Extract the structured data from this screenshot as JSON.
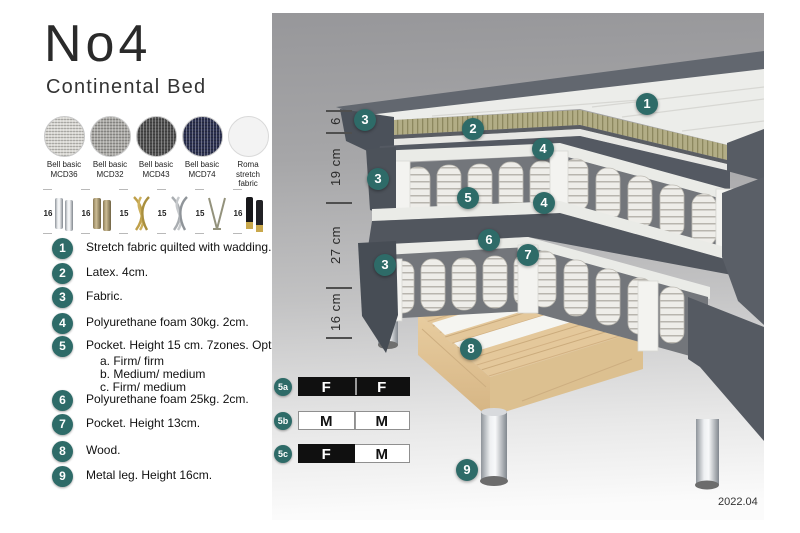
{
  "header": {
    "title": "No4",
    "subtitle": "Continental Bed"
  },
  "swatches": [
    {
      "line1": "Bell basic",
      "line2": "MCD36",
      "color": "#d8d7d2"
    },
    {
      "line1": "Bell basic",
      "line2": "MCD32",
      "color": "#a9a8a4"
    },
    {
      "line1": "Bell basic",
      "line2": "MCD43",
      "color": "#4e4e4e"
    },
    {
      "line1": "Bell basic",
      "line2": "MCD74",
      "color": "#2c3150"
    },
    {
      "line1": "Roma",
      "line2": "stretch fabric",
      "color": "#f3f3f3"
    }
  ],
  "legs": [
    {
      "height": "16",
      "type": "cylinder-silver"
    },
    {
      "height": "16",
      "type": "cylinder-brass"
    },
    {
      "height": "15",
      "type": "twisted-gold"
    },
    {
      "height": "15",
      "type": "twisted-silver"
    },
    {
      "height": "15",
      "type": "hairpin"
    },
    {
      "height": "16",
      "type": "cylinder-black-gold"
    }
  ],
  "features": [
    {
      "num": "1",
      "text": "Stretch fabric quilted with wadding."
    },
    {
      "num": "2",
      "text": "Latex. 4cm."
    },
    {
      "num": "3",
      "text": "Fabric."
    },
    {
      "num": "4",
      "text": "Polyurethane foam 30kg. 2cm."
    },
    {
      "num": "5",
      "text": "Pocket. Height 15 cm. 7zones. Option:",
      "options": [
        "a. Firm/ firm",
        "b. Medium/ medium",
        "c. Firm/ medium"
      ]
    },
    {
      "num": "6",
      "text": "Polyurethane foam 25kg. 2cm."
    },
    {
      "num": "7",
      "text": "Pocket. Height 13cm."
    },
    {
      "num": "8",
      "text": "Wood."
    },
    {
      "num": "9",
      "text": "Metal leg. Height 16cm."
    }
  ],
  "diagram": {
    "dimensions": [
      "6",
      "19 cm",
      "27 cm",
      "16 cm"
    ],
    "badges": [
      "1",
      "2",
      "3",
      "4",
      "3",
      "5",
      "4",
      "6",
      "7",
      "3",
      "8",
      "9"
    ]
  },
  "firmness": {
    "rows": [
      {
        "id": "5a",
        "cells": [
          {
            "label": "F",
            "variant": "dark"
          },
          {
            "label": "F",
            "variant": "dark"
          }
        ]
      },
      {
        "id": "5b",
        "cells": [
          {
            "label": "M",
            "variant": "light"
          },
          {
            "label": "M",
            "variant": "light"
          }
        ]
      },
      {
        "id": "5c",
        "cells": [
          {
            "label": "F",
            "variant": "dark"
          },
          {
            "label": "M",
            "variant": "light"
          }
        ]
      }
    ]
  },
  "footer": {
    "version": "2022.04"
  },
  "colors": {
    "accent_teal": "#2E6B68",
    "panel_top": "#97979A",
    "panel_bottom": "#FBFBFB",
    "latex": "#B2AD86",
    "wood": "#E4C89B",
    "bed_side": "#555A62"
  }
}
